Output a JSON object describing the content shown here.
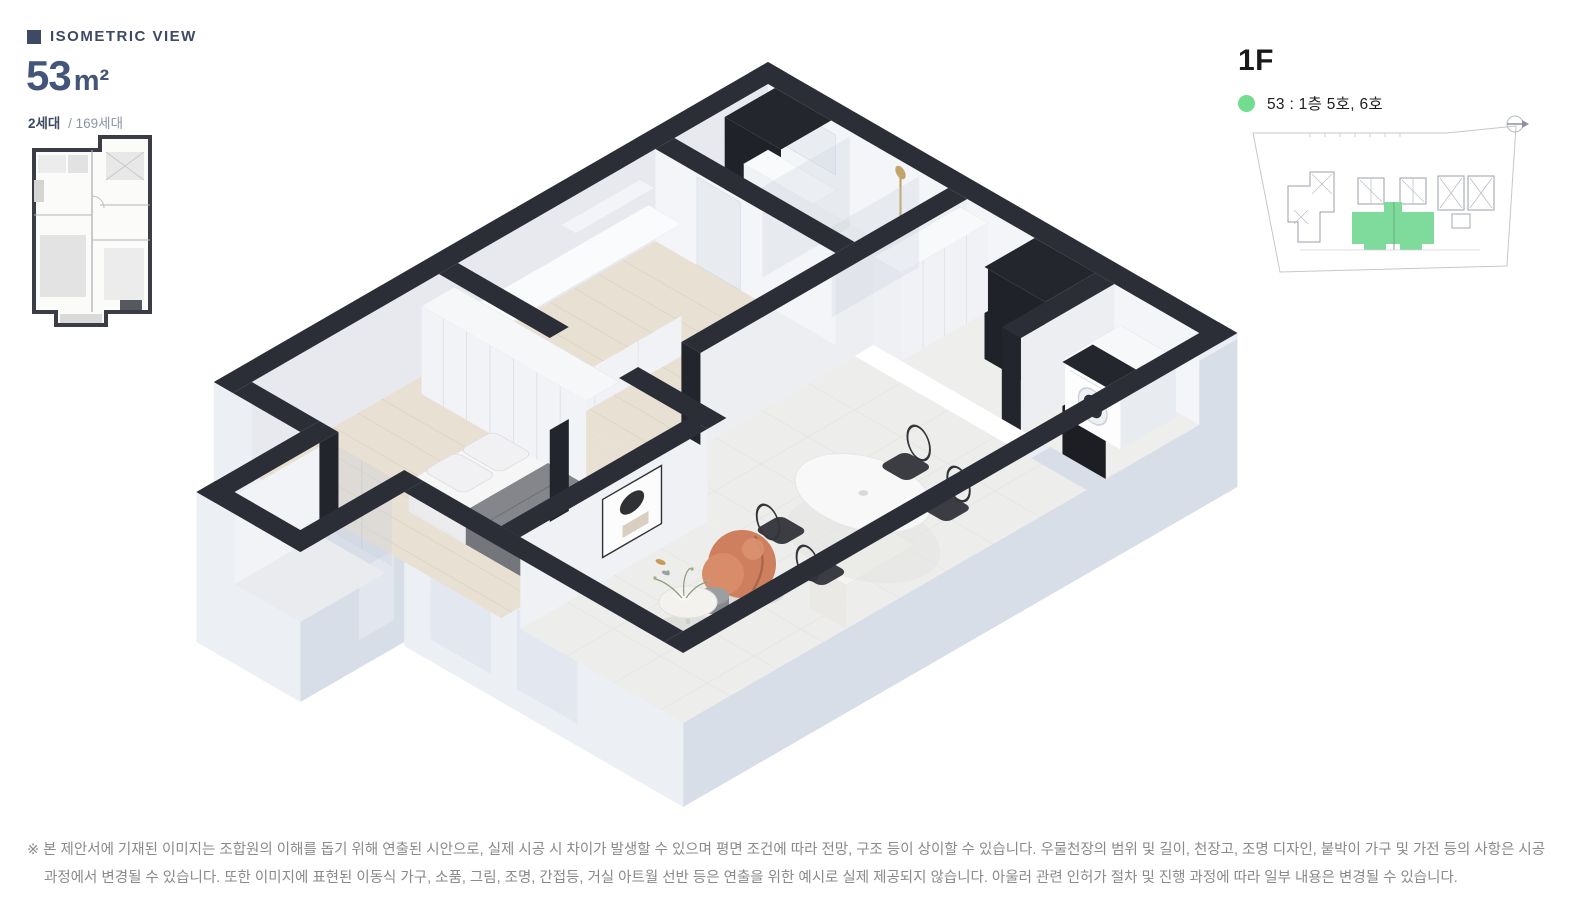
{
  "header": {
    "section_label": "ISOMETRIC VIEW",
    "area_number": "53",
    "area_unit": "m²",
    "household_bold": "2세대",
    "household_rest": "/ 169세대"
  },
  "floor_info": {
    "floor_label": "1F",
    "legend_text": "53 : 1층 5호, 6호"
  },
  "disclaimer": {
    "line1": "※ 본 제안서에 기재된 이미지는 조합원의 이해를 돕기 위해 연출된 시안으로, 실제 시공 시 차이가 발생할 수 있으며 평면 조건에 따라 전망, 구조 등이 상이할 수 있습니다. 우물천장의 범위 및 길이, 천장고, 조명 디자인, 붙박이 가구 및 가전 등의 사항은 시공",
    "line2": "과정에서 변경될 수 있습니다. 또한 이미지에 표현된 이동식 가구, 소품, 그림, 조명, 간접등, 거실 아트월 선반 등은 연출을 위한 예시로 실제 제공되지 않습니다. 아울러 관련 인허가 절차 및 진행 과정에 따라 일부 내용은 변경될 수 있습니다."
  },
  "colors": {
    "accent_navy": "#3e4a63",
    "area_text": "#44557a",
    "legend_green": "#72dd8e",
    "keyplan_highlight": "#7fdb9c",
    "wall_dark": "#2b2e37",
    "exterior_light": "#d8dee8",
    "floor_wood": "#e8e0d3",
    "floor_tile": "#ededeb",
    "lounge_chair_orange": "#cd7f5e",
    "disclaimer_gray": "#8a8a8a"
  },
  "icons": {
    "north_arrow": "north-arrow-icon",
    "legend_dot": "legend-color-dot",
    "section_bullet": "section-square-bullet"
  }
}
